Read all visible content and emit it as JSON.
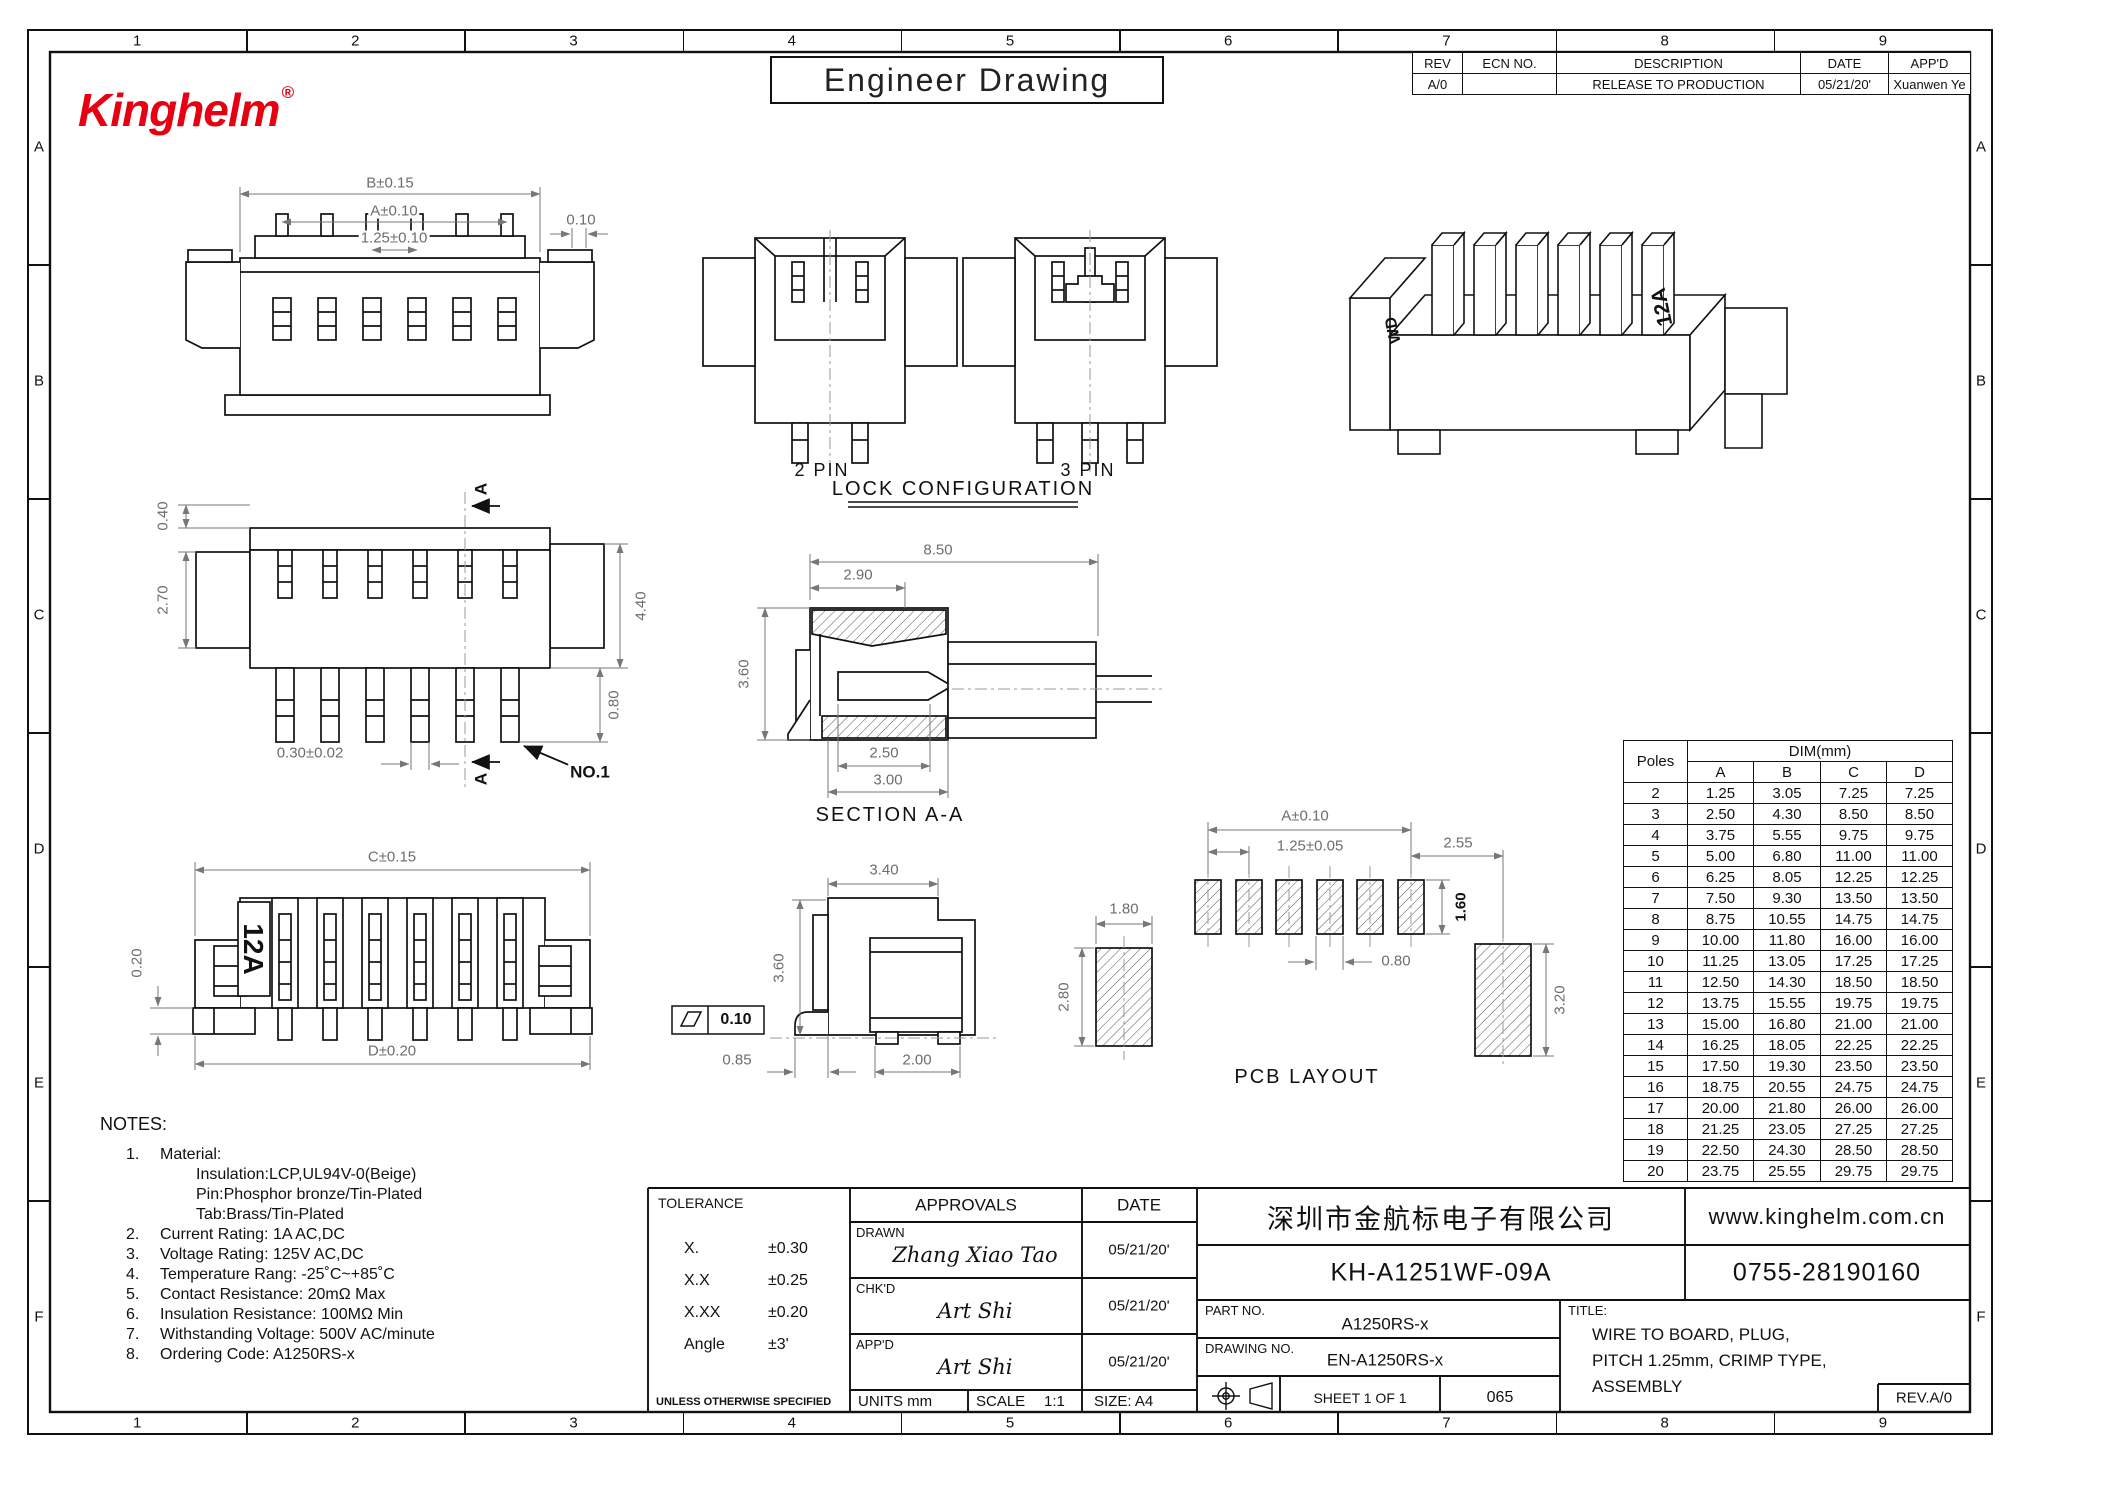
{
  "border": {
    "columns": [
      "1",
      "2",
      "3",
      "4",
      "5",
      "6",
      "7",
      "8",
      "9"
    ],
    "rows": [
      "A",
      "B",
      "C",
      "D",
      "E",
      "F"
    ]
  },
  "header": {
    "logo_text": "Kinghelm",
    "logo_reg": "®",
    "sheet_title": "Engineer Drawing",
    "rev_table": {
      "headers": [
        "REV",
        "ECN NO.",
        "DESCRIPTION",
        "DATE",
        "APP'D"
      ],
      "row": [
        "A/0",
        "",
        "RELEASE TO PRODUCTION",
        "05/21/20'",
        "Xuanwen Ye"
      ]
    }
  },
  "views": {
    "front": {
      "dim_b": "B±0.15",
      "dim_a": "A±0.10",
      "dim_pitch": "1.25±0.10",
      "dim_tab": "0.10"
    },
    "lock": {
      "label_2pin": "2 PIN",
      "label_3pin": "3 PIN",
      "caption": "LOCK CONFIGURATION"
    },
    "iso": {
      "marking": "12A",
      "marking_left": "WD"
    },
    "side": {
      "dim_top": "0.40",
      "dim_left": "2.70",
      "dim_right": "4.40",
      "dim_pin_width": "0.30±0.02",
      "dim_pin_length": "0.80",
      "section_letter": "A",
      "pin_label": "NO.1"
    },
    "section": {
      "dim_total": "8.50",
      "dim_front": "2.90",
      "dim_height": "3.60",
      "dim_inner": "2.50",
      "dim_outer": "3.00",
      "caption": "SECTION A-A"
    },
    "bottom": {
      "dim_c": "C±0.15",
      "dim_standoff": "0.20",
      "dim_d": "D±0.20",
      "marking": "12A"
    },
    "side2": {
      "dim_width": "3.40",
      "dim_height": "3.60",
      "dim_foot": "0.85",
      "dim_pad": "2.00",
      "flatness": "0.10"
    },
    "pcb": {
      "dim_a": "A±0.10",
      "dim_pitch": "1.25±0.05",
      "dim_end": "2.55",
      "dim_side_pad_width": "1.80",
      "dim_pad_height": "1.60",
      "dim_pad_width": "0.80",
      "dim_side_pad_height_left": "2.80",
      "dim_side_pad_height_right": "3.20",
      "caption": "PCB LAYOUT"
    }
  },
  "poles_table": {
    "col_poles": "Poles",
    "col_dim": "DIM(mm)",
    "sub_cols": [
      "A",
      "B",
      "C",
      "D"
    ],
    "rows": [
      [
        "2",
        "1.25",
        "3.05",
        "7.25",
        "7.25"
      ],
      [
        "3",
        "2.50",
        "4.30",
        "8.50",
        "8.50"
      ],
      [
        "4",
        "3.75",
        "5.55",
        "9.75",
        "9.75"
      ],
      [
        "5",
        "5.00",
        "6.80",
        "11.00",
        "11.00"
      ],
      [
        "6",
        "6.25",
        "8.05",
        "12.25",
        "12.25"
      ],
      [
        "7",
        "7.50",
        "9.30",
        "13.50",
        "13.50"
      ],
      [
        "8",
        "8.75",
        "10.55",
        "14.75",
        "14.75"
      ],
      [
        "9",
        "10.00",
        "11.80",
        "16.00",
        "16.00"
      ],
      [
        "10",
        "11.25",
        "13.05",
        "17.25",
        "17.25"
      ],
      [
        "11",
        "12.50",
        "14.30",
        "18.50",
        "18.50"
      ],
      [
        "12",
        "13.75",
        "15.55",
        "19.75",
        "19.75"
      ],
      [
        "13",
        "15.00",
        "16.80",
        "21.00",
        "21.00"
      ],
      [
        "14",
        "16.25",
        "18.05",
        "22.25",
        "22.25"
      ],
      [
        "15",
        "17.50",
        "19.30",
        "23.50",
        "23.50"
      ],
      [
        "16",
        "18.75",
        "20.55",
        "24.75",
        "24.75"
      ],
      [
        "17",
        "20.00",
        "21.80",
        "26.00",
        "26.00"
      ],
      [
        "18",
        "21.25",
        "23.05",
        "27.25",
        "27.25"
      ],
      [
        "19",
        "22.50",
        "24.30",
        "28.50",
        "28.50"
      ],
      [
        "20",
        "23.75",
        "25.55",
        "29.75",
        "29.75"
      ]
    ]
  },
  "notes": {
    "title": "NOTES:",
    "items": [
      {
        "num": "1.",
        "text": "Material:",
        "sub": [
          "Insulation:LCP,UL94V-0(Beige)",
          "Pin:Phosphor bronze/Tin-Plated",
          "Tab:Brass/Tin-Plated"
        ]
      },
      {
        "num": "2.",
        "text": "Current Rating: 1A AC,DC"
      },
      {
        "num": "3.",
        "text": "Voltage Rating: 125V AC,DC"
      },
      {
        "num": "4.",
        "text": "Temperature Rang: -25˚C~+85˚C"
      },
      {
        "num": "5.",
        "text": "Contact Resistance: 20mΩ Max"
      },
      {
        "num": "6.",
        "text": "Insulation Resistance: 100MΩ Min"
      },
      {
        "num": "7.",
        "text": "Withstanding Voltage: 500V AC/minute"
      },
      {
        "num": "8.",
        "text": "Ordering Code: A1250RS-x"
      }
    ]
  },
  "title_block": {
    "tolerance_title": "TOLERANCE",
    "tolerance_rows": [
      [
        "X.",
        "±0.30"
      ],
      [
        "X.X",
        "±0.25"
      ],
      [
        "X.XX",
        "±0.20"
      ],
      [
        "Angle",
        "±3'"
      ]
    ],
    "tolerance_note": "UNLESS OTHERWISE SPECIFIED",
    "approvals_header": "APPROVALS",
    "date_header": "DATE",
    "approvals": [
      {
        "role": "DRAWN",
        "name": "Zhang Xiao Tao",
        "date": "05/21/20'"
      },
      {
        "role": "CHK'D",
        "name": "Art Shi",
        "date": "05/21/20'"
      },
      {
        "role": "APP'D",
        "name": "Art Shi",
        "date": "05/21/20'"
      }
    ],
    "units_label": "UNITS mm",
    "scale_label": "SCALE",
    "scale_value": "1:1",
    "size_label": "SIZE: A4",
    "company": "深圳市金航标电子有限公司",
    "website": "www.kinghelm.com.cn",
    "model": "KH-A1251WF-09A",
    "phone": "0755-28190160",
    "part_no_label": "PART NO.",
    "part_no": "A1250RS-x",
    "drawing_no_label": "DRAWING NO.",
    "drawing_no": "EN-A1250RS-x",
    "title_label": "TITLE:",
    "title_lines": [
      "WIRE TO BOARD, PLUG,",
      "PITCH 1.25mm, CRIMP TYPE,",
      "ASSEMBLY"
    ],
    "sheet_label": "SHEET 1 OF 1",
    "code": "065",
    "rev": "REV.A/0"
  }
}
